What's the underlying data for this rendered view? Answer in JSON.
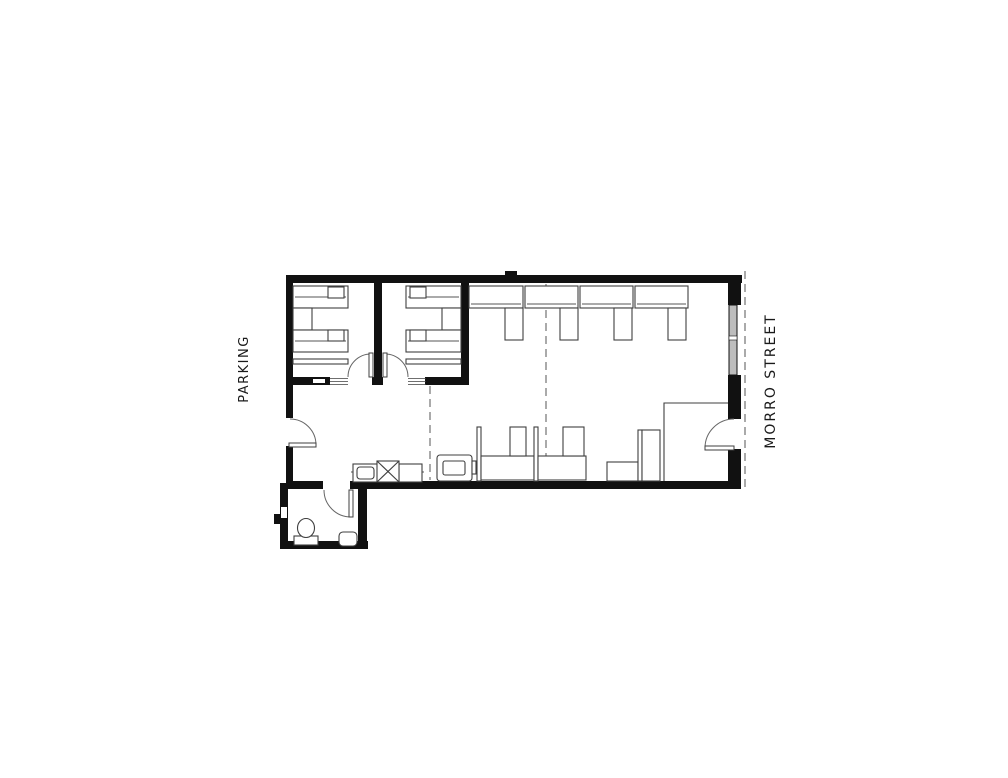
{
  "labels": {
    "parking": "PARKING",
    "morro_street": "MORRO STREET"
  },
  "colors": {
    "background": "#ffffff",
    "walls": "#111111",
    "furniture_line": "#3f3f3f",
    "window_glass": "#bdbdbd",
    "reference_dash": "#555555",
    "label_text": "#1a1a1a"
  }
}
